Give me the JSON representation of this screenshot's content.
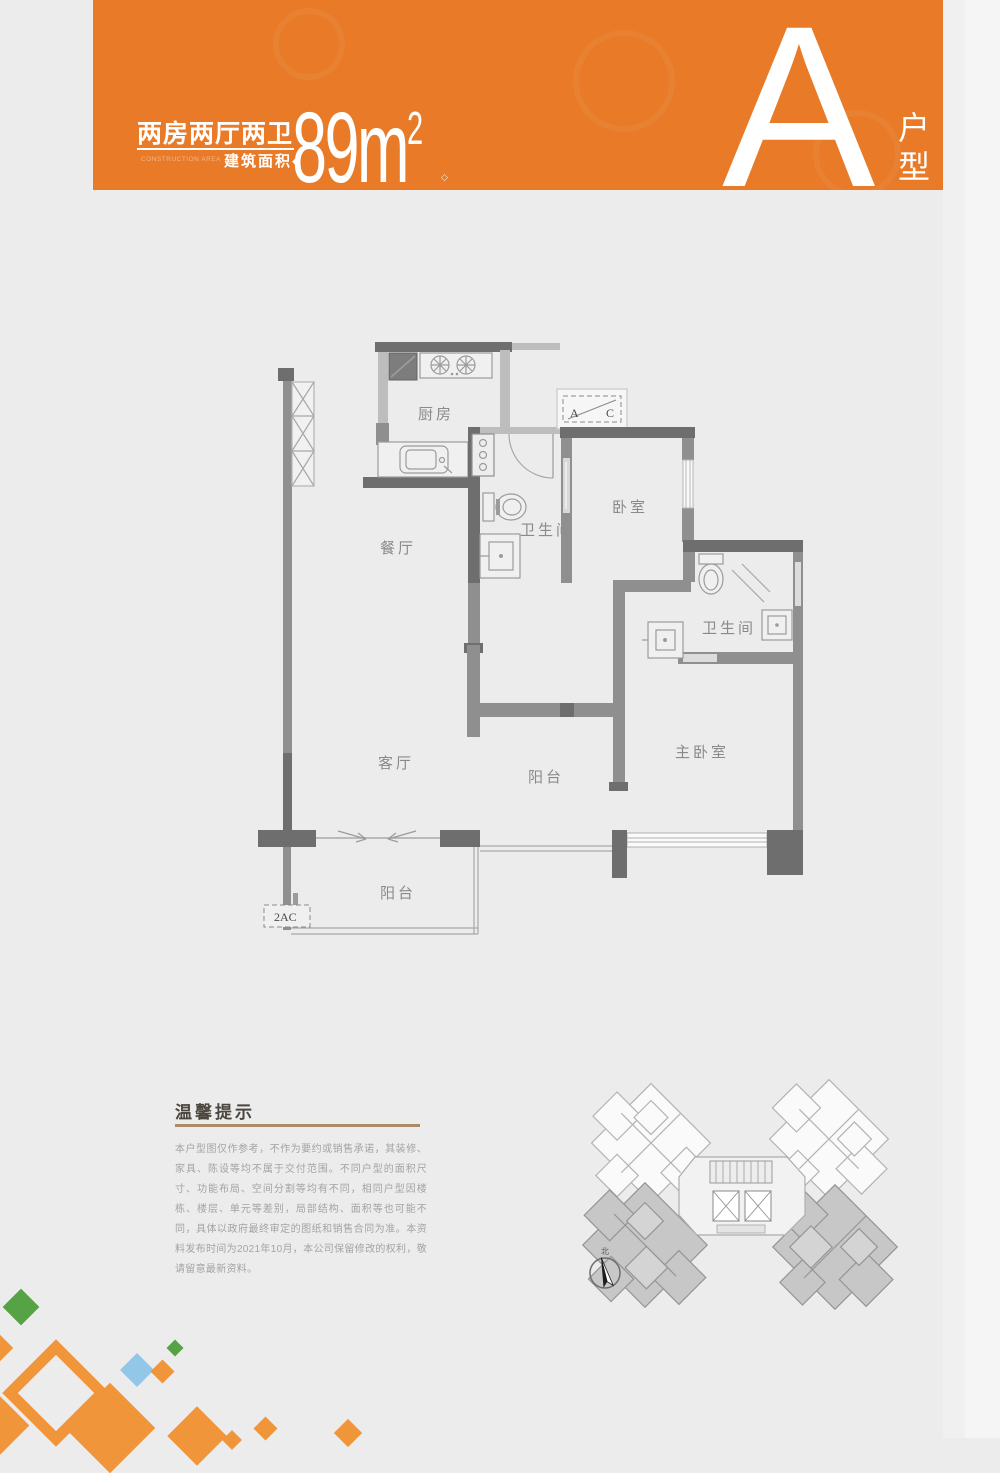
{
  "colors": {
    "accent": "#e87a28",
    "diamond_orange": "#f0953a",
    "diamond_green": "#55a344",
    "diamond_blue": "#92c7e8",
    "wall_dark": "#6e6e6e",
    "wall_mid": "#8f8f8f"
  },
  "header": {
    "title": "两房两厅两卫",
    "area_caption_en": "CONSTRUCTION AREA",
    "area_caption_cn": "建筑面积",
    "area_caption_diamond": "◆",
    "area_value": "89m",
    "area_sup": "2",
    "reg_mark": "◇",
    "unit_letter": "A",
    "unit_label_char1": "户",
    "unit_label_char2": "型"
  },
  "floorplan": {
    "rooms": [
      {
        "id": "kitchen",
        "label": "厨房"
      },
      {
        "id": "dining",
        "label": "餐厅"
      },
      {
        "id": "bath-1",
        "label": "卫生间"
      },
      {
        "id": "bedroom",
        "label": "卧室"
      },
      {
        "id": "bath-2",
        "label": "卫生间"
      },
      {
        "id": "living",
        "label": "客厅"
      },
      {
        "id": "balcony-right",
        "label": "阳台"
      },
      {
        "id": "master-bedroom",
        "label": "主卧室"
      },
      {
        "id": "balcony-bottom",
        "label": "阳台"
      }
    ],
    "markers": {
      "ac_split_a": "A",
      "ac_split_c": "C",
      "ac_count": "2AC"
    }
  },
  "siteplan": {
    "compass_label": "北"
  },
  "tips": {
    "title": "温馨提示",
    "body": "本户型图仅作参考，不作为要约或销售承诺，其装修、家具、陈设等均不属于交付范围。不同户型的面积尺寸、功能布局、空间分割等均有不同，相同户型因楼栋、楼层、单元等差别，局部结构、面积等也可能不同，具体以政府最终审定的图纸和销售合同为准。本资料发布时间为2021年10月，本公司保留修改的权利，敬请留意最新资料。"
  }
}
